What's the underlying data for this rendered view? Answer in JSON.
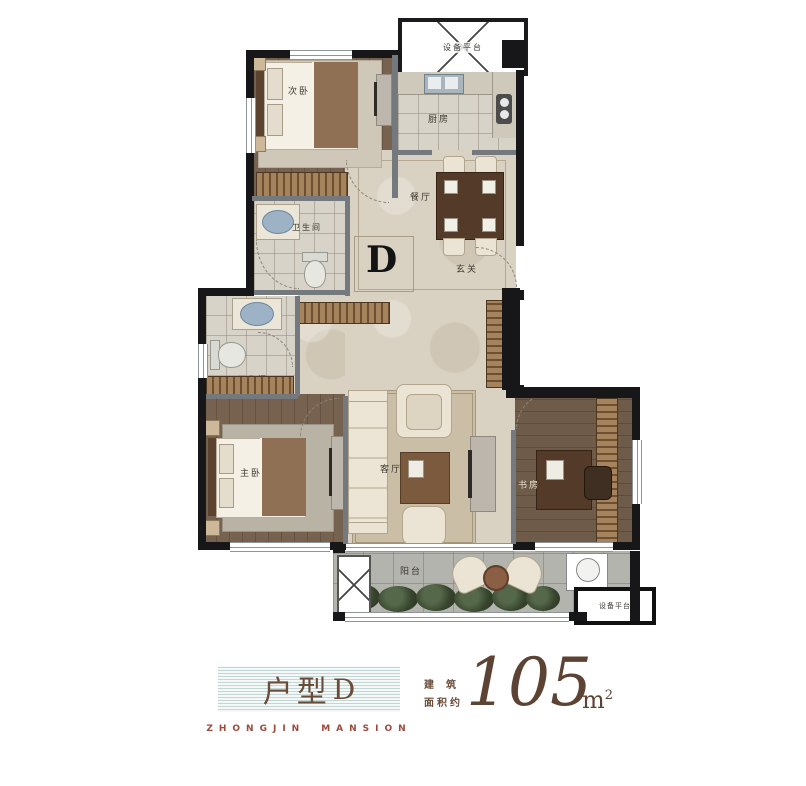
{
  "plan": {
    "unit_letter": "D",
    "labels": {
      "bedroom2": "次卧",
      "kitchen": "厨房",
      "dining": "餐厅",
      "foyer": "玄关",
      "bath_upper": "卫生间",
      "bath_lower": "卫生间",
      "master_bedroom": "主卧",
      "living_room": "客厅",
      "study": "书房",
      "balcony": "阳台",
      "equipment_top": "设备平台",
      "equipment_bottom": "设备平台"
    }
  },
  "footer": {
    "unit_type_prefix": "户型",
    "unit_type_letter": "D",
    "brand_word_left": "ZHONGJIN",
    "brand_word_right": "MANSION",
    "area_label_line1": "建筑",
    "area_label_line2": "面积约",
    "area_value": "105",
    "area_unit_letter": "m",
    "area_unit_exponent": "2"
  },
  "colors": {
    "accent_brown": "#6b4c38",
    "brand_red": "#9c4a3c",
    "seal_red": "#c23a2e",
    "stripe_teal": "#c3d6d5",
    "wall_black": "#17171a",
    "wall_gray": "#73797c"
  }
}
